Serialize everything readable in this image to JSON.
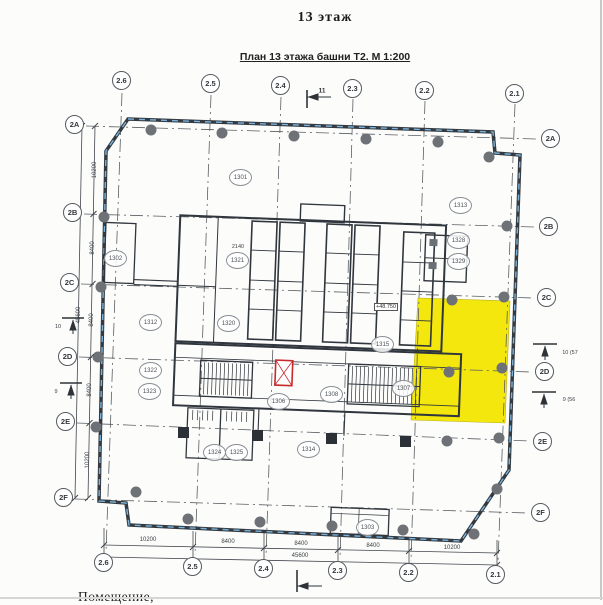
{
  "header": {
    "floor_title": "13 этаж",
    "plan_subtitle": "План 13 этажа башни Т2. М 1:200"
  },
  "grid": {
    "cols": [
      "2.6",
      "2.5",
      "2.4",
      "2.3",
      "2.2",
      "2.1"
    ],
    "rows": [
      "2A",
      "2B",
      "2C",
      "2D",
      "2E",
      "2F"
    ]
  },
  "rooms": [
    "1301",
    "1302",
    "1313",
    "1328",
    "1329",
    "1321",
    "1312",
    "1320",
    "1315",
    "1322",
    "1323",
    "1306",
    "1308",
    "1307",
    "1314",
    "1324",
    "1325",
    "1303"
  ],
  "dims": {
    "h_segments": [
      "10200",
      "8400",
      "8400",
      "8400",
      "10200"
    ],
    "h_total": "45600",
    "v_segments": [
      "10200",
      "8400",
      "8400",
      "8400",
      "10200"
    ],
    "v_total": "45600",
    "door_width": "2140",
    "elevation": "+48.750"
  },
  "sections": {
    "top": "11",
    "right_upper": "10 (57",
    "right_lower": "9 (56",
    "left_upper": "10",
    "left_lower": "9"
  },
  "footer": {
    "note": "Помещение,"
  },
  "colors": {
    "highlight_yellow": "#f4e70d",
    "alert_red": "#c9292b",
    "wall_accent_blue": "#79b2dc"
  }
}
